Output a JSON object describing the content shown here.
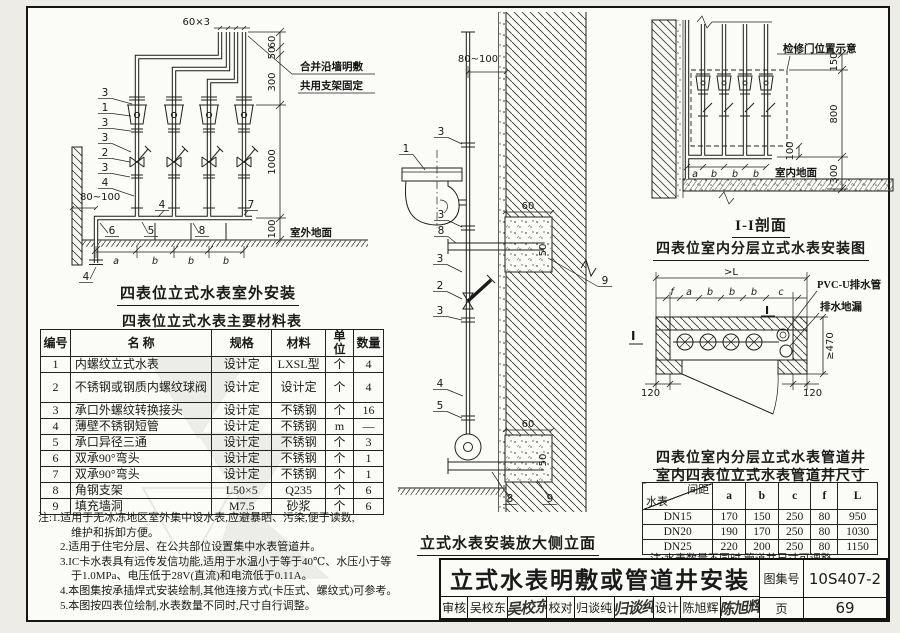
{
  "page": {
    "paper": "#fbfbf7",
    "ink": "#1a1a1a"
  },
  "left": {
    "diagram": {
      "title": "四表位立式水表室外安装",
      "dim_top": "60×3",
      "note1": "合并沿墙明敷",
      "note2": "共用支架固定",
      "dim_60": "60",
      "dim_50": "50",
      "dim_300": "300",
      "dim_1000": "1000",
      "dim_100": "100",
      "dim_80100": "80~100",
      "ground": "室外地面",
      "spacing": {
        "a": "a",
        "b": "b"
      },
      "callouts": {
        "n1": "1",
        "n2": "2",
        "n3": "3",
        "n4": "4",
        "n5": "5",
        "n6": "6",
        "n7": "7",
        "n8": "8"
      }
    },
    "materials_table": {
      "title": "四表位立式水表主要材料表",
      "headers": [
        "编号",
        "名  称",
        "规格",
        "材料",
        "单位",
        "数量"
      ],
      "rows": [
        [
          "1",
          "内螺纹立式水表",
          "设计定",
          "LXSL型",
          "个",
          "4"
        ],
        [
          "2",
          "不锈钢或钢质内螺纹球阀",
          "设计定",
          "设计定",
          "个",
          "4"
        ],
        [
          "3",
          "承口外螺纹转换接头",
          "设计定",
          "不锈钢",
          "个",
          "16"
        ],
        [
          "4",
          "薄壁不锈钢短管",
          "设计定",
          "不锈钢",
          "m",
          "—"
        ],
        [
          "5",
          "承口异径三通",
          "设计定",
          "不锈钢",
          "个",
          "3"
        ],
        [
          "6",
          "双承90°弯头",
          "设计定",
          "不锈钢",
          "个",
          "1"
        ],
        [
          "7",
          "双承90°弯头",
          "设计定",
          "不锈钢",
          "个",
          "1"
        ],
        [
          "8",
          "角钢支架",
          "L50×5",
          "Q235",
          "个",
          "6"
        ],
        [
          "9",
          "填充墙洞",
          "M7.5",
          "砂浆",
          "个",
          "6"
        ]
      ]
    },
    "notes": [
      "注:1.适用于无冰冻地区室外集中设水表,应避暴晒、污染,便于读数,",
      "维护和拆卸方便。",
      "2.适用于住宅分层、在公共部位设置集中水表管道井。",
      "3.IC卡水表具有远传发信功能,适用于水温小于等于40℃、水压小于等",
      "于1.0MPa、电压低于28V(直流)和电流低于0.11A。",
      "4.本图集按承插焊式安装绘制,其他连接方式(卡压式、螺纹式)可参考。",
      "5.本图按四表位绘制,水表数量不同时,尺寸自行调整。"
    ]
  },
  "middle": {
    "diagram": {
      "title": "立式水表安装放大侧立面",
      "dim_top": "80~100",
      "dim_60": "60",
      "dim_50": "50",
      "callouts": {
        "n1": "1",
        "n2": "2",
        "n3": "3",
        "n4": "4",
        "n5": "5",
        "n8": "8",
        "n9": "9"
      }
    }
  },
  "right": {
    "section": {
      "title": "I-I剖面",
      "subtitle": "四表位室内分层立式水表安装图",
      "door_note": "检修门位置示意",
      "dim_150": "150",
      "dim_800": "800",
      "dim_300": "300",
      "dim_100": "100",
      "ground": "室内地面",
      "spacing": {
        "a": "a",
        "b": "b"
      }
    },
    "shaft": {
      "title": "四表位室内分层立式水表管道井",
      "dim_L": ">L",
      "segs": [
        "f",
        "a",
        "b",
        "b",
        "b",
        "c"
      ],
      "dim_470": "≥470",
      "dim_120": "120",
      "ann_pipe": "PVC-U排水管",
      "ann_drain": "排水地漏",
      "marker": "I"
    },
    "size_table": {
      "title": "室内四表位立式水表管道井尺寸",
      "diag_top": "间距",
      "diag_bottom": "水表",
      "columns": [
        "a",
        "b",
        "c",
        "f",
        "L"
      ],
      "rows": [
        {
          "meter": "DN15",
          "values": [
            "170",
            "150",
            "250",
            "80",
            "950"
          ]
        },
        {
          "meter": "DN20",
          "values": [
            "190",
            "170",
            "250",
            "80",
            "1030"
          ]
        },
        {
          "meter": "DN25",
          "values": [
            "220",
            "200",
            "250",
            "80",
            "1150"
          ]
        }
      ],
      "note": "注:水表数量不同时,管道井尺寸可调整。"
    }
  },
  "titleblock": {
    "title": "立式水表明敷或管道井安装",
    "atlas_label": "图集号",
    "atlas_no": "10S407-2",
    "page_label": "页",
    "page_no": "69",
    "people": [
      {
        "role": "审核",
        "name": "吴校东",
        "sig": "吴校东"
      },
      {
        "role": "校对",
        "name": "归谈纯",
        "sig": "归谈纯"
      },
      {
        "role": "设计",
        "name": "陈旭辉",
        "sig": "陈旭辉"
      }
    ]
  }
}
